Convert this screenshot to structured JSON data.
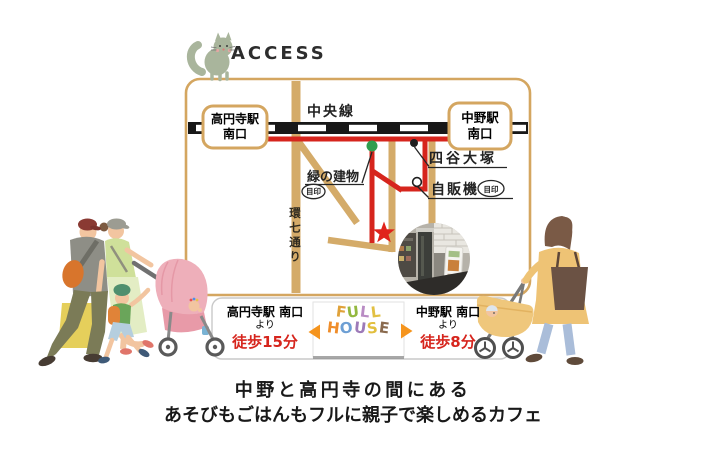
{
  "header": {
    "title": "ACCESS"
  },
  "map": {
    "rail_line": "中央線",
    "station_left": {
      "name": "高円寺駅",
      "exit": "南口"
    },
    "station_right": {
      "name": "中野駅",
      "exit": "南口"
    },
    "landmark_green_building": {
      "label": "緑の建物",
      "badge": "目印"
    },
    "landmark_yotsuya_otsuka": {
      "label": "四谷大塚"
    },
    "landmark_vending_machine": {
      "label": "自販機",
      "badge": "目印"
    },
    "street_kannana": {
      "label": "環七通り"
    }
  },
  "access_bar": {
    "left": {
      "station": "高円寺駅 南口",
      "via": "より",
      "walk_time": "徒歩15分"
    },
    "right": {
      "station": "中野駅 南口",
      "via": "より",
      "walk_time": "徒歩8分"
    }
  },
  "logo": {
    "line1": [
      {
        "ch": "F",
        "color": "#e0a23a"
      },
      {
        "ch": "U",
        "color": "#93b83f"
      },
      {
        "ch": "L",
        "color": "#b98cc4"
      },
      {
        "ch": "L",
        "color": "#e2c043"
      }
    ],
    "line2": [
      {
        "ch": "H",
        "color": "#ef8d2a"
      },
      {
        "ch": "O",
        "color": "#6d9fd4"
      },
      {
        "ch": "U",
        "color": "#9d7ab8"
      },
      {
        "ch": "S",
        "color": "#e2bf3e"
      },
      {
        "ch": "E",
        "color": "#8a6a4e"
      }
    ]
  },
  "tagline": {
    "line1": "中野と高円寺の間にある",
    "line2": "あそびもごはんもフルに親子で楽しめるカフェ"
  },
  "colors": {
    "route_red": "#d6251d",
    "road_tan": "#d4ab69",
    "map_frame": "#d4a660",
    "star_red": "#e0231c",
    "walk_time_red": "#d6251d",
    "arrow_orange": "#f5941d",
    "green_marker": "#2f9e4f"
  }
}
